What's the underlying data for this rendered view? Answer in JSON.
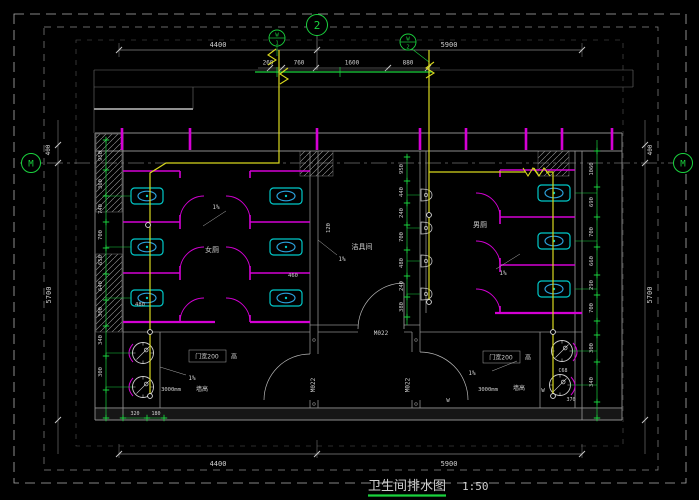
{
  "colors": {
    "background": "#000000",
    "grid_green": "#1ad23e",
    "wall_magenta": "#d400d4",
    "fixture_cyan": "#00c8c8",
    "pipe_yellow": "#d8d81e",
    "structure_gray": "#8c8c8c",
    "dim_text": "#cfcfcf"
  },
  "title": {
    "text": "卫生间排水图",
    "scale": "1:50"
  },
  "grid": {
    "left_bubble": "M",
    "right_bubble": "M",
    "top_bubble": "2"
  },
  "risers": {
    "r1_letter": "W",
    "r1_num": "1",
    "r2_letter": "W",
    "r2_num": "2"
  },
  "dims": {
    "top": {
      "left": "4400",
      "right": "5900"
    },
    "sub": [
      "260",
      "760",
      "1600",
      "880"
    ],
    "bottom": {
      "left": "4400",
      "right": "5900"
    },
    "left_edge": {
      "offset": "400",
      "total": "5700"
    },
    "right_edge": {
      "offset": "400",
      "total": "5700"
    },
    "chain_left": [
      "950",
      "360",
      "740",
      "700",
      "650",
      "640",
      "300",
      "340",
      "300"
    ],
    "chain_mid": [
      "950",
      "440",
      "240",
      "700",
      "480",
      "240",
      "380"
    ],
    "chain_right": [
      "1060",
      "690",
      "700",
      "660",
      "290",
      "700",
      "300",
      "340"
    ],
    "inner": {
      "left_a": "480",
      "left_b": "460",
      "bottom_a": "320",
      "bottom_b": "180",
      "mid_small": "120"
    }
  },
  "rooms": {
    "left": "女厕",
    "middle": "洁具间",
    "right": "男厕"
  },
  "notes": {
    "slope": "1%",
    "door_width": "门宽200",
    "door_height": "高",
    "wall_height_value": "3000mm",
    "wall_height_label": "墙高",
    "door_tag": "M022",
    "pipe_w": "W",
    "fixture_code": "C68",
    "fixture_dim": "370"
  }
}
